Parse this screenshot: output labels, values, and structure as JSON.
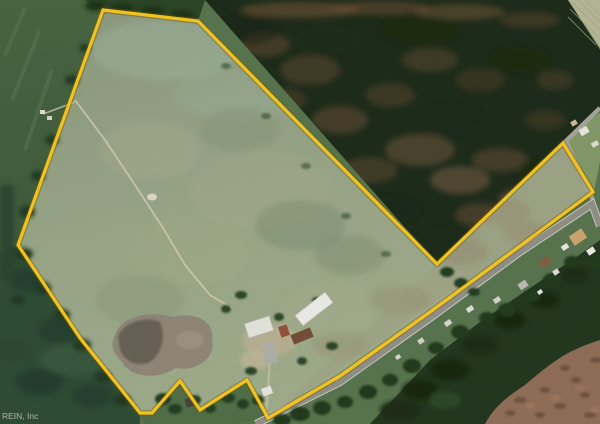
{
  "title": "Aerial satellite view of rural property with outlined parcel",
  "watermark": {
    "text": "REIN, Inc"
  },
  "boundary": {
    "color": "#F2C21D",
    "points": "103,10 198,21 437,264 563,143 593,192 520,246 430,312 340,376 268,418 247,380 200,410 180,381 152,413 140,413 80,338 18,245"
  },
  "scene": {
    "land_inside": "open pasture with farm buildings and gravel lot",
    "land_northeast": "dense dark pine forest with brown mottled patches",
    "land_southeast": "rural road with houses and cleared brown ground",
    "road_color": "#8b8b82",
    "forest_color": "#1c2a19",
    "pasture_color": "#93a183"
  }
}
